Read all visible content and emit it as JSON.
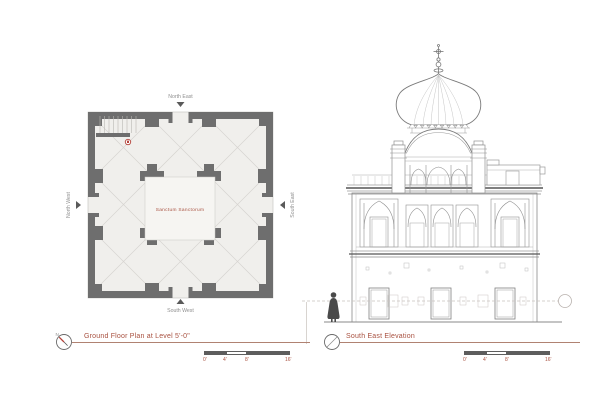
{
  "sheet": {
    "background": "#ffffff"
  },
  "plan": {
    "title": "Ground Floor Plan at Level 5'-0\"",
    "compass_letter": "N",
    "center_label": "Sanctum Sanctorum",
    "labels": {
      "top": "North East",
      "left": "North West",
      "right": "South East",
      "bottom": "South West"
    }
  },
  "elevation": {
    "title": "South East Elevation"
  },
  "scale_bars": [
    {
      "ticks": [
        "0'",
        "4'",
        "8'",
        "16'"
      ]
    },
    {
      "ticks": [
        "0'",
        "4'",
        "8'",
        "16'"
      ]
    }
  ],
  "colors": {
    "wall": "#6e6e6e",
    "accent": "#a8503f",
    "line": "#8f8f8f",
    "line_light": "#c6c6c6",
    "figure": "#4a4a4a",
    "underline": "#b08272",
    "scale_dark": "#5d5d5d"
  }
}
